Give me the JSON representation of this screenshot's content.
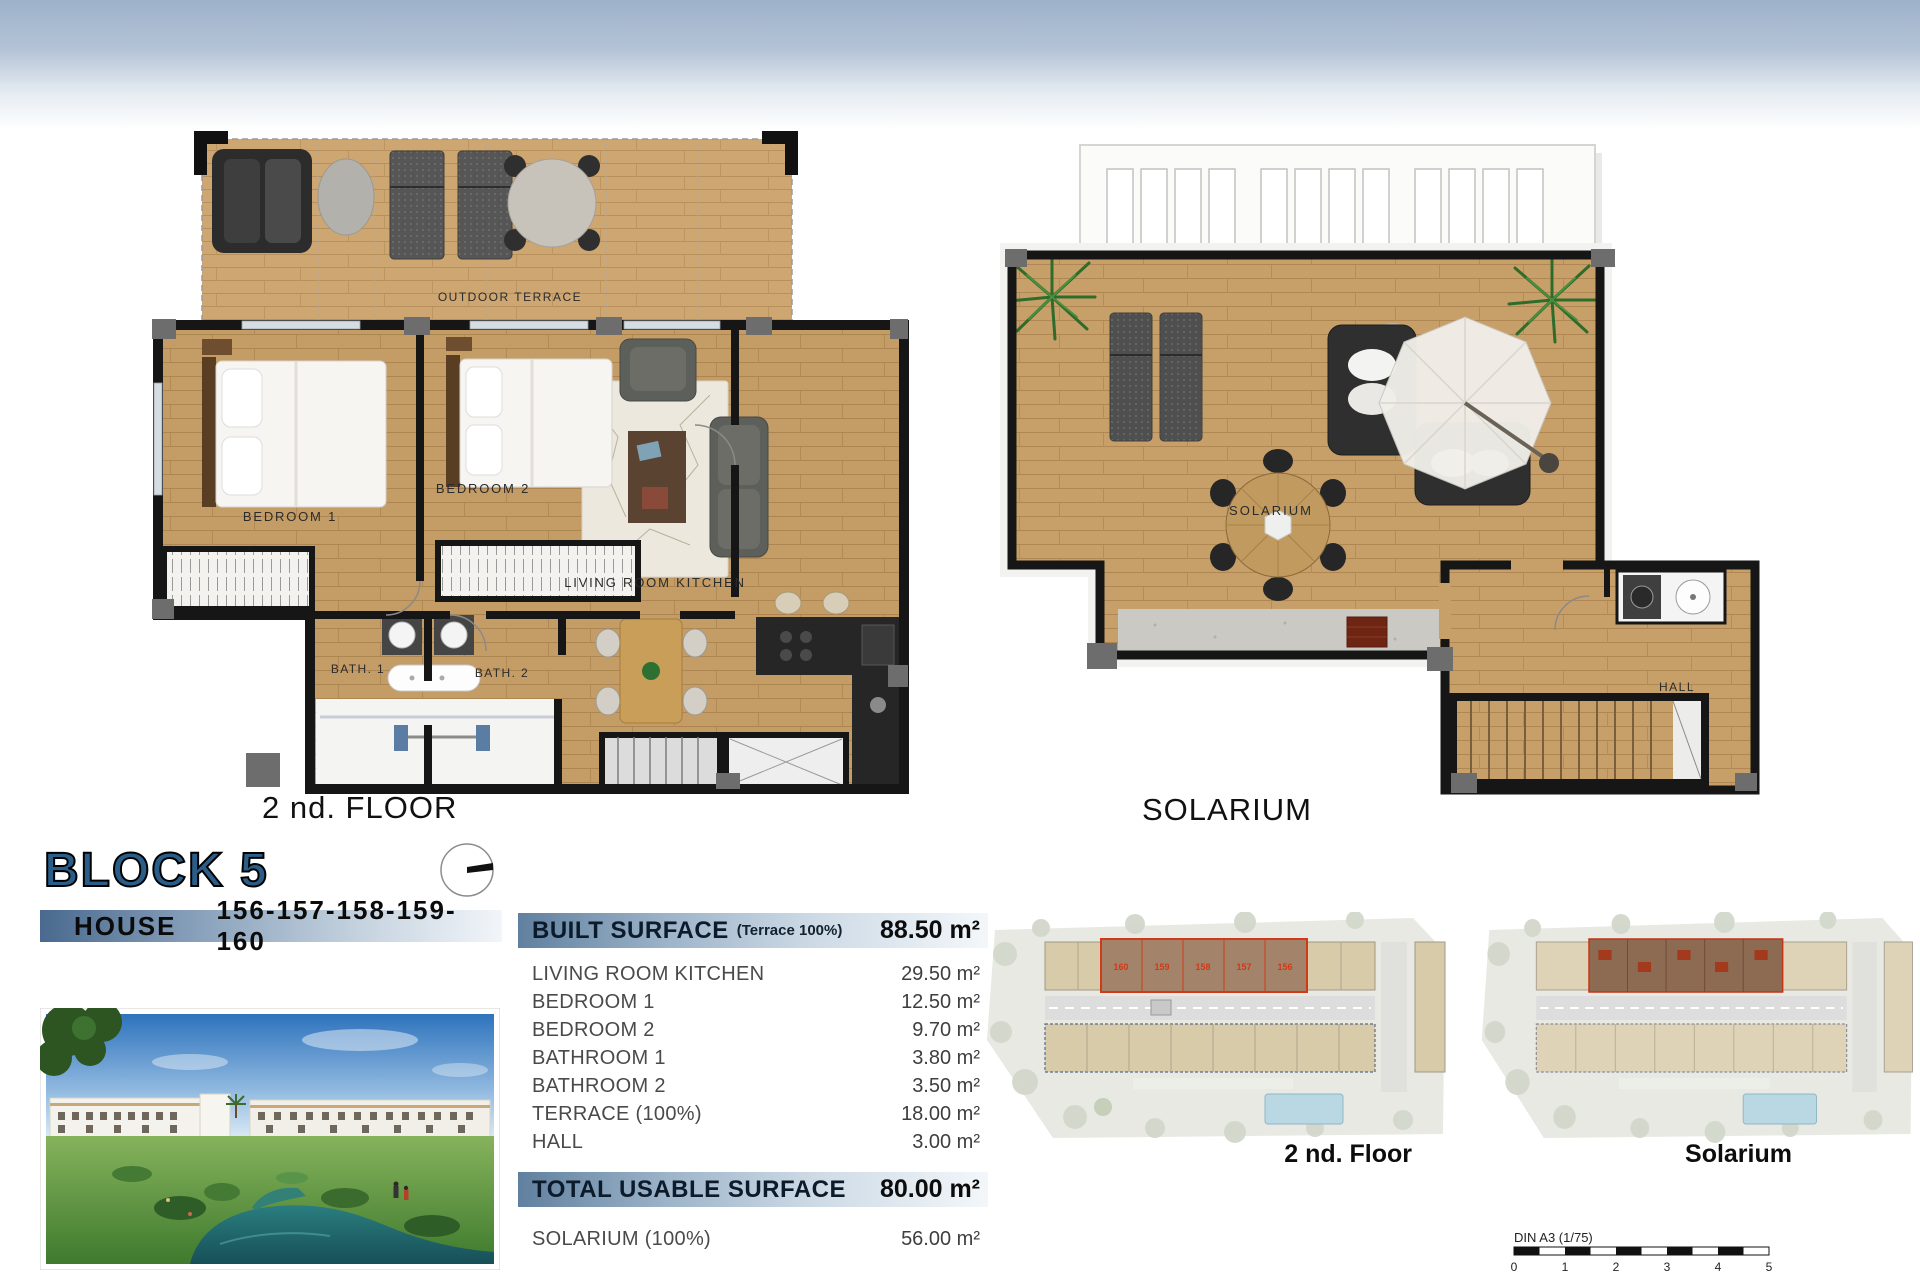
{
  "header": {
    "block_title": "BLOCK 5",
    "house_label": "HOUSE",
    "house_numbers": "156-157-158-159-160"
  },
  "floor_plan_2nd": {
    "caption": "2 nd. FLOOR",
    "labels": {
      "outdoor_terrace": "OUTDOOR TERRACE",
      "bedroom1": "BEDROOM 1",
      "bedroom2": "BEDROOM 2",
      "living": "LIVING ROOM KITCHEN",
      "bath1": "BATH. 1",
      "bath2": "BATH. 2"
    }
  },
  "solarium_plan": {
    "caption": "SOLARIUM",
    "labels": {
      "solarium": "SOLARIUM",
      "hall": "HALL"
    }
  },
  "surface_table": {
    "built": {
      "label": "BUILT SURFACE",
      "note": "(Terrace 100%)",
      "value": "88.50 m²"
    },
    "rows": [
      {
        "label": "LIVING ROOM KITCHEN",
        "value": "29.50 m²"
      },
      {
        "label": "BEDROOM 1",
        "value": "12.50 m²"
      },
      {
        "label": "BEDROOM 2",
        "value": "9.70 m²"
      },
      {
        "label": "BATHROOM 1",
        "value": "3.80 m²"
      },
      {
        "label": "BATHROOM 2",
        "value": "3.50 m²"
      },
      {
        "label": "TERRACE (100%)",
        "value": "18.00 m²"
      },
      {
        "label": "HALL",
        "value": "3.00 m²"
      }
    ],
    "total": {
      "label": "TOTAL USABLE SURFACE",
      "value": "80.00 m²"
    },
    "solarium": {
      "label": "SOLARIUM (100%)",
      "value": "56.00 m²"
    }
  },
  "site_plans": {
    "floor_caption": "2 nd. Floor",
    "solarium_caption": "Solarium",
    "highlighted_units": [
      "160",
      "159",
      "158",
      "157",
      "156"
    ]
  },
  "scale_bar": {
    "label": "DIN A3 (1/75)",
    "ticks": [
      "0",
      "1",
      "2",
      "3",
      "4",
      "5"
    ]
  },
  "colors": {
    "accent_blue": "#2a5e88",
    "band_blue": "#9db2ca",
    "wood": "#c49c66",
    "wall": "#161616",
    "highlight_red": "#d03a18"
  }
}
